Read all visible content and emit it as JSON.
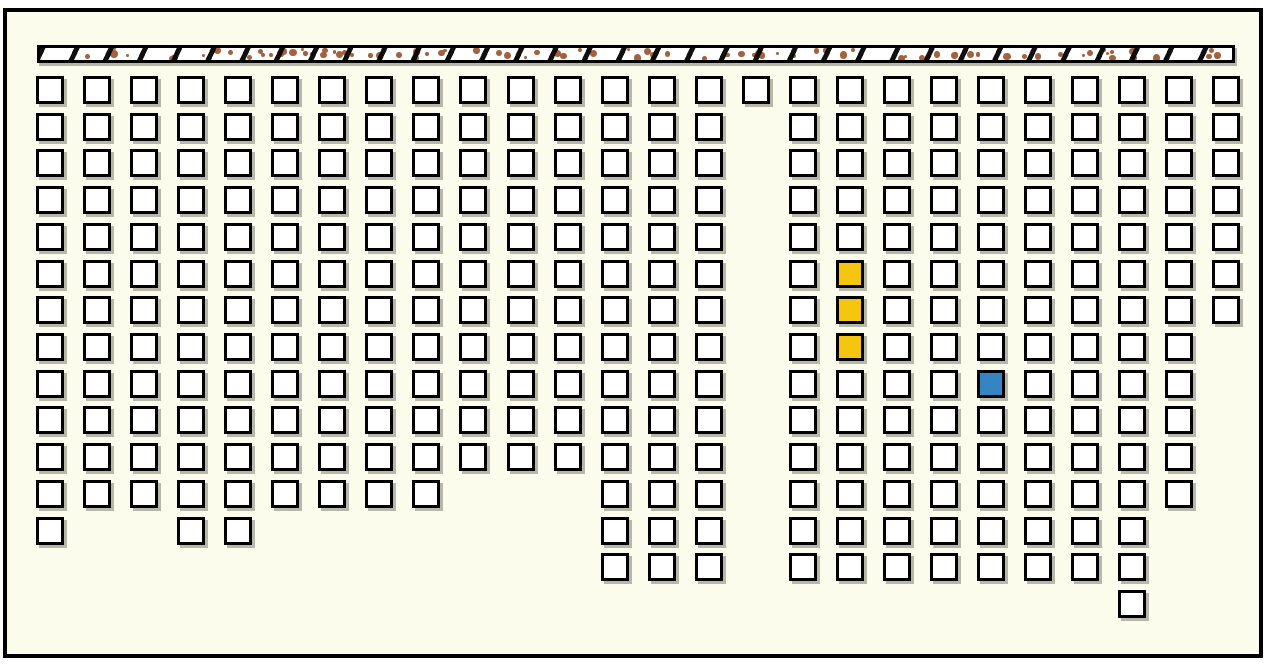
{
  "board": {
    "outer_background_color": "#FFFFFF",
    "frame_color": "#000000",
    "background_color": "#FCFCEC"
  },
  "hatched_bar": {
    "x": 37,
    "y": 45,
    "width": 1198,
    "height": 18,
    "fill_color": "#FFFFFF",
    "border_color": "#000000",
    "slash_color": "#050505",
    "dot_color": "#A5613C",
    "dot_count": 88
  },
  "grid": {
    "columns": 26,
    "rows": 15,
    "origin_x": 36,
    "origin_y": 76,
    "pitch_x": 47.05,
    "pitch_y": 36.72,
    "cell_size": 28,
    "cell_border_px": 3,
    "cell_fill_color": "#FFFFFF",
    "cell_border_color": "#000000",
    "cell_shadow_color": "rgba(100,100,90,0.45)"
  },
  "occupancy": {
    "note_total_cells": 319,
    "column_row_spans": [
      {
        "col": 0,
        "from_row": 0,
        "to_row": 12
      },
      {
        "col": 1,
        "from_row": 0,
        "to_row": 11
      },
      {
        "col": 2,
        "from_row": 0,
        "to_row": 11
      },
      {
        "col": 3,
        "from_row": 0,
        "to_row": 12
      },
      {
        "col": 4,
        "from_row": 0,
        "to_row": 12
      },
      {
        "col": 5,
        "from_row": 0,
        "to_row": 11
      },
      {
        "col": 6,
        "from_row": 0,
        "to_row": 11
      },
      {
        "col": 7,
        "from_row": 0,
        "to_row": 11
      },
      {
        "col": 8,
        "from_row": 0,
        "to_row": 11
      },
      {
        "col": 9,
        "from_row": 0,
        "to_row": 10
      },
      {
        "col": 10,
        "from_row": 0,
        "to_row": 10
      },
      {
        "col": 11,
        "from_row": 0,
        "to_row": 10
      },
      {
        "col": 12,
        "from_row": 0,
        "to_row": 13
      },
      {
        "col": 13,
        "from_row": 0,
        "to_row": 13
      },
      {
        "col": 14,
        "from_row": 0,
        "to_row": 13
      },
      {
        "col": 15,
        "from_row": 0,
        "to_row": 0
      },
      {
        "col": 16,
        "from_row": 0,
        "to_row": 13
      },
      {
        "col": 17,
        "from_row": 0,
        "to_row": 13
      },
      {
        "col": 18,
        "from_row": 0,
        "to_row": 13
      },
      {
        "col": 19,
        "from_row": 0,
        "to_row": 13
      },
      {
        "col": 20,
        "from_row": 0,
        "to_row": 13
      },
      {
        "col": 21,
        "from_row": 0,
        "to_row": 13
      },
      {
        "col": 22,
        "from_row": 0,
        "to_row": 13
      },
      {
        "col": 23,
        "from_row": 0,
        "to_row": 14
      },
      {
        "col": 24,
        "from_row": 0,
        "to_row": 11
      },
      {
        "col": 25,
        "from_row": 0,
        "to_row": 6
      }
    ],
    "excluded_cells": [
      {
        "col": 1,
        "row": 12
      },
      {
        "col": 2,
        "row": 12
      }
    ],
    "highlighted_cells": [
      {
        "col": 17,
        "row": 5,
        "color_key": "yellow"
      },
      {
        "col": 17,
        "row": 6,
        "color_key": "yellow"
      },
      {
        "col": 17,
        "row": 7,
        "color_key": "yellow"
      },
      {
        "col": 20,
        "row": 8,
        "color_key": "blue"
      }
    ],
    "highlight_colors": {
      "yellow": "#F6C50F",
      "blue": "#3584C4"
    }
  }
}
